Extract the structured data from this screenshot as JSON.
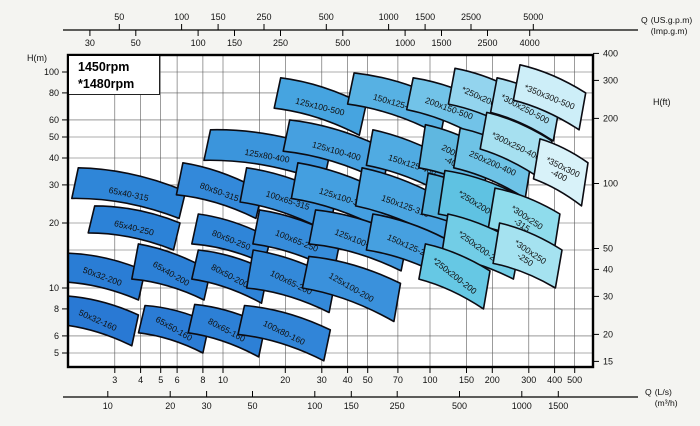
{
  "rpm_box": {
    "line1": "1450rpm",
    "line2": "*1480rpm"
  },
  "axis_labels": {
    "left": "H(m)",
    "right": "H(ft)",
    "top_prefix": "Q",
    "top_line1": "(US.g.p.m)",
    "top_line2": "(Imp.g.m)",
    "bottom_prefix": "Q",
    "bottom_line1": "(L/s)",
    "bottom_line2": "(m³/h)"
  },
  "style": {
    "region_stroke": "#0b0b12",
    "grid_color": "#5a5a5a",
    "border_color": "#000000",
    "plot_bg": "#ffffff"
  },
  "chart_data": {
    "type": "area",
    "title": "Centrifugal pump range selection chart, 1450rpm / *1480rpm",
    "x_axis": {
      "name": "Q",
      "scale": "log",
      "units": [
        "L/s",
        "m³/h",
        "US.g.p.m",
        "Imp.g.m"
      ],
      "range_ls": [
        1.78,
        610
      ]
    },
    "y_axis": {
      "name": "H",
      "scale": "log",
      "units": [
        "m",
        "ft"
      ],
      "range_m": [
        4.3,
        121
      ]
    },
    "ticks": {
      "h_m": [
        100,
        80,
        60,
        50,
        40,
        30,
        20,
        10,
        8,
        6,
        5
      ],
      "h_ft": [
        400,
        300,
        200,
        100,
        50,
        40,
        30,
        20,
        15
      ],
      "q_ls": [
        3,
        4,
        5,
        6,
        8,
        10,
        20,
        30,
        40,
        50,
        70,
        100,
        150,
        200,
        300,
        400,
        500
      ],
      "q_m3h": [
        10,
        20,
        30,
        50,
        100,
        150,
        250,
        500,
        1000,
        1500
      ],
      "q_usgpm": [
        50,
        100,
        150,
        250,
        500,
        1000,
        1500,
        2500,
        5000
      ],
      "q_impgpm": [
        30,
        50,
        100,
        150,
        250,
        500,
        1000,
        1500,
        2500,
        4000
      ]
    },
    "grid": {
      "x_ls": [
        3,
        4,
        5,
        6,
        8,
        10,
        15,
        20,
        30,
        40,
        50,
        70,
        100,
        150,
        200,
        300,
        400,
        500
      ],
      "y_m": [
        5,
        6,
        8,
        10,
        15,
        20,
        30,
        40,
        50,
        60,
        80,
        100
      ]
    },
    "regions": [
      {
        "label": [
          "125x100-500"
        ],
        "q": [
          19,
          49
        ],
        "h": [
          94,
          70,
          51,
          68
        ],
        "color": "#46a4e0",
        "rot": 14
      },
      {
        "label": [
          "150x125-500"
        ],
        "q": [
          43,
          121
        ],
        "h": [
          99,
          73,
          51,
          71
        ],
        "color": "#57b1e3",
        "rot": 16
      },
      {
        "label": [
          "200x150-500"
        ],
        "q": [
          83,
          198
        ],
        "h": [
          94,
          70,
          48,
          67
        ],
        "color": "#72c3e8",
        "rot": 20
      },
      {
        "label": [
          "*250x200-500"
        ],
        "q": [
          132,
          287
        ],
        "h": [
          104,
          78,
          53,
          71
        ],
        "color": "#93d4ee",
        "rot": 24
      },
      {
        "label": [
          "*300x250-500"
        ],
        "q": [
          211,
          424
        ],
        "h": [
          94,
          71,
          48,
          65
        ],
        "color": "#a8def1",
        "rot": 28
      },
      {
        "label": [
          "*350x300-500"
        ],
        "q": [
          272,
          565
        ],
        "h": [
          108,
          80,
          54,
          74
        ],
        "color": "#cdeef8",
        "rot": 22
      },
      {
        "label": [
          "125x80-400"
        ],
        "q": [
          8.7,
          33
        ],
        "h": [
          54,
          43,
          31,
          39
        ],
        "color": "#3b95dc",
        "rot": 10
      },
      {
        "label": [
          "125x100-400"
        ],
        "q": [
          21,
          64
        ],
        "h": [
          60,
          43,
          31,
          43
        ],
        "color": "#46a0e0",
        "rot": 16
      },
      {
        "label": [
          "150x125-400"
        ],
        "q": [
          53,
          137
        ],
        "h": [
          54,
          37,
          26,
          37
        ],
        "color": "#50abe2",
        "rot": 18
      },
      {
        "label": [
          "200x150",
          "-400"
        ],
        "q": [
          95,
          195
        ],
        "h": [
          57,
          43,
          28,
          36
        ],
        "color": "#5fb7e0",
        "rot": 28
      },
      {
        "label": [
          "250x200-400"
        ],
        "q": [
          140,
          310
        ],
        "h": [
          55,
          40,
          26,
          36
        ],
        "color": "#6ec3e6",
        "rot": 24
      },
      {
        "label": [
          "*300x250-400"
        ],
        "q": [
          188,
          388
        ],
        "h": [
          65,
          48,
          31,
          44
        ],
        "color": "#a6e0f0",
        "rot": 26
      },
      {
        "label": [
          "*350x300",
          "-400"
        ],
        "q": [
          340,
          580
        ],
        "h": [
          49,
          38,
          24,
          32
        ],
        "color": "#d8f2f9",
        "rot": 26
      },
      {
        "label": [
          "65x40-315"
        ],
        "q": [
          2.0,
          6.6
        ],
        "h": [
          36,
          28,
          21,
          26
        ],
        "color": "#2f86d8",
        "rot": 12
      },
      {
        "label": [
          "80x50-315"
        ],
        "q": [
          6.4,
          15.5
        ],
        "h": [
          38,
          28,
          21,
          27
        ],
        "color": "#3389da",
        "rot": 20
      },
      {
        "label": [
          "100x65-315"
        ],
        "q": [
          13,
          35
        ],
        "h": [
          36,
          26,
          18,
          25
        ],
        "color": "#3a92dc",
        "rot": 18
      },
      {
        "label": [
          "125x100-315"
        ],
        "q": [
          23,
          68
        ],
        "h": [
          38,
          26,
          18,
          26
        ],
        "color": "#449fe0",
        "rot": 18
      },
      {
        "label": [
          "150x125-315"
        ],
        "q": [
          47,
          132
        ],
        "h": [
          36,
          24,
          16,
          24
        ],
        "color": "#4aa5e1",
        "rot": 20
      },
      {
        "label": [
          "200x150",
          "-315"
        ],
        "q": [
          98,
          195
        ],
        "h": [
          34,
          26,
          17,
          22
        ],
        "color": "#52b0dc",
        "rot": 30
      },
      {
        "label": [
          "*250x200-315"
        ],
        "q": [
          118,
          287
        ],
        "h": [
          35,
          26,
          16,
          22
        ],
        "color": "#5fc2e2",
        "rot": 32
      },
      {
        "label": [
          "*300x250",
          "-315"
        ],
        "q": [
          206,
          424
        ],
        "h": [
          29,
          22,
          14,
          19
        ],
        "color": "#8fdcec",
        "rot": 34
      },
      {
        "label": [
          "65x40-250"
        ],
        "q": [
          2.4,
          6.2
        ],
        "h": [
          24,
          20,
          15,
          18
        ],
        "color": "#2c82d7",
        "rot": 14
      },
      {
        "label": [
          "80x50-250"
        ],
        "q": [
          7.6,
          17
        ],
        "h": [
          22,
          17,
          13,
          16
        ],
        "color": "#2f85d8",
        "rot": 22
      },
      {
        "label": [
          "100x65-250"
        ],
        "q": [
          15,
          37
        ],
        "h": [
          23,
          17,
          12,
          16
        ],
        "color": "#368cda",
        "rot": 22
      },
      {
        "label": [
          "125x100-250"
        ],
        "q": [
          28,
          78
        ],
        "h": [
          23,
          17,
          12,
          16
        ],
        "color": "#3f97de",
        "rot": 22
      },
      {
        "label": [
          "150x125-250"
        ],
        "q": [
          53,
          132
        ],
        "h": [
          22,
          16,
          11,
          15
        ],
        "color": "#46a0e0",
        "rot": 24
      },
      {
        "label": [
          "*250x200-250"
        ],
        "q": [
          122,
          272
        ],
        "h": [
          22,
          16,
          11,
          14
        ],
        "color": "#72cde6",
        "rot": 36
      },
      {
        "label": [
          "*300x250",
          "-250"
        ],
        "q": [
          217,
          434
        ],
        "h": [
          20,
          15,
          10,
          13
        ],
        "color": "#a5e2f0",
        "rot": 34
      },
      {
        "label": [
          "50x32-200"
        ],
        "q": [
          1.75,
          4.2
        ],
        "h": [
          14.5,
          12,
          8.8,
          10.7
        ],
        "color": "#2a7dd5",
        "rot": 20
      },
      {
        "label": [
          "65x40-200"
        ],
        "q": [
          3.9,
          8.7
        ],
        "h": [
          16,
          12,
          8.8,
          11
        ],
        "color": "#2c80d6",
        "rot": 30
      },
      {
        "label": [
          "80x50-200"
        ],
        "q": [
          7.6,
          16.5
        ],
        "h": [
          15,
          12,
          8.5,
          11
        ],
        "color": "#2e83d7",
        "rot": 28
      },
      {
        "label": [
          "100x65-200"
        ],
        "q": [
          14,
          35
        ],
        "h": [
          15,
          11,
          7.7,
          10
        ],
        "color": "#3389d9",
        "rot": 26
      },
      {
        "label": [
          "125x100-200"
        ],
        "q": [
          26,
          72
        ],
        "h": [
          14,
          10.5,
          7,
          10
        ],
        "color": "#3a91dc",
        "rot": 30
      },
      {
        "label": [
          "*250x200-200"
        ],
        "q": [
          95,
          195
        ],
        "h": [
          16,
          12,
          8,
          11
        ],
        "color": "#66c8e4",
        "rot": 38
      },
      {
        "label": [
          "50x32-160"
        ],
        "q": [
          1.7,
          3.9
        ],
        "h": [
          9.2,
          7.5,
          5.4,
          6.8
        ],
        "color": "#2979d4",
        "rot": 24
      },
      {
        "label": [
          "65x50-160"
        ],
        "q": [
          4.2,
          8.6
        ],
        "h": [
          8.3,
          6.9,
          5.0,
          6.2
        ],
        "color": "#2b7cd5",
        "rot": 30
      },
      {
        "label": [
          "80x65-160"
        ],
        "q": [
          7.3,
          16
        ],
        "h": [
          8.4,
          6.7,
          4.8,
          6.2
        ],
        "color": "#2d80d6",
        "rot": 28
      },
      {
        "label": [
          "100x80-160"
        ],
        "q": [
          12.7,
          33
        ],
        "h": [
          8.3,
          6.4,
          4.6,
          6.1
        ],
        "color": "#3185d8",
        "rot": 26
      }
    ]
  }
}
